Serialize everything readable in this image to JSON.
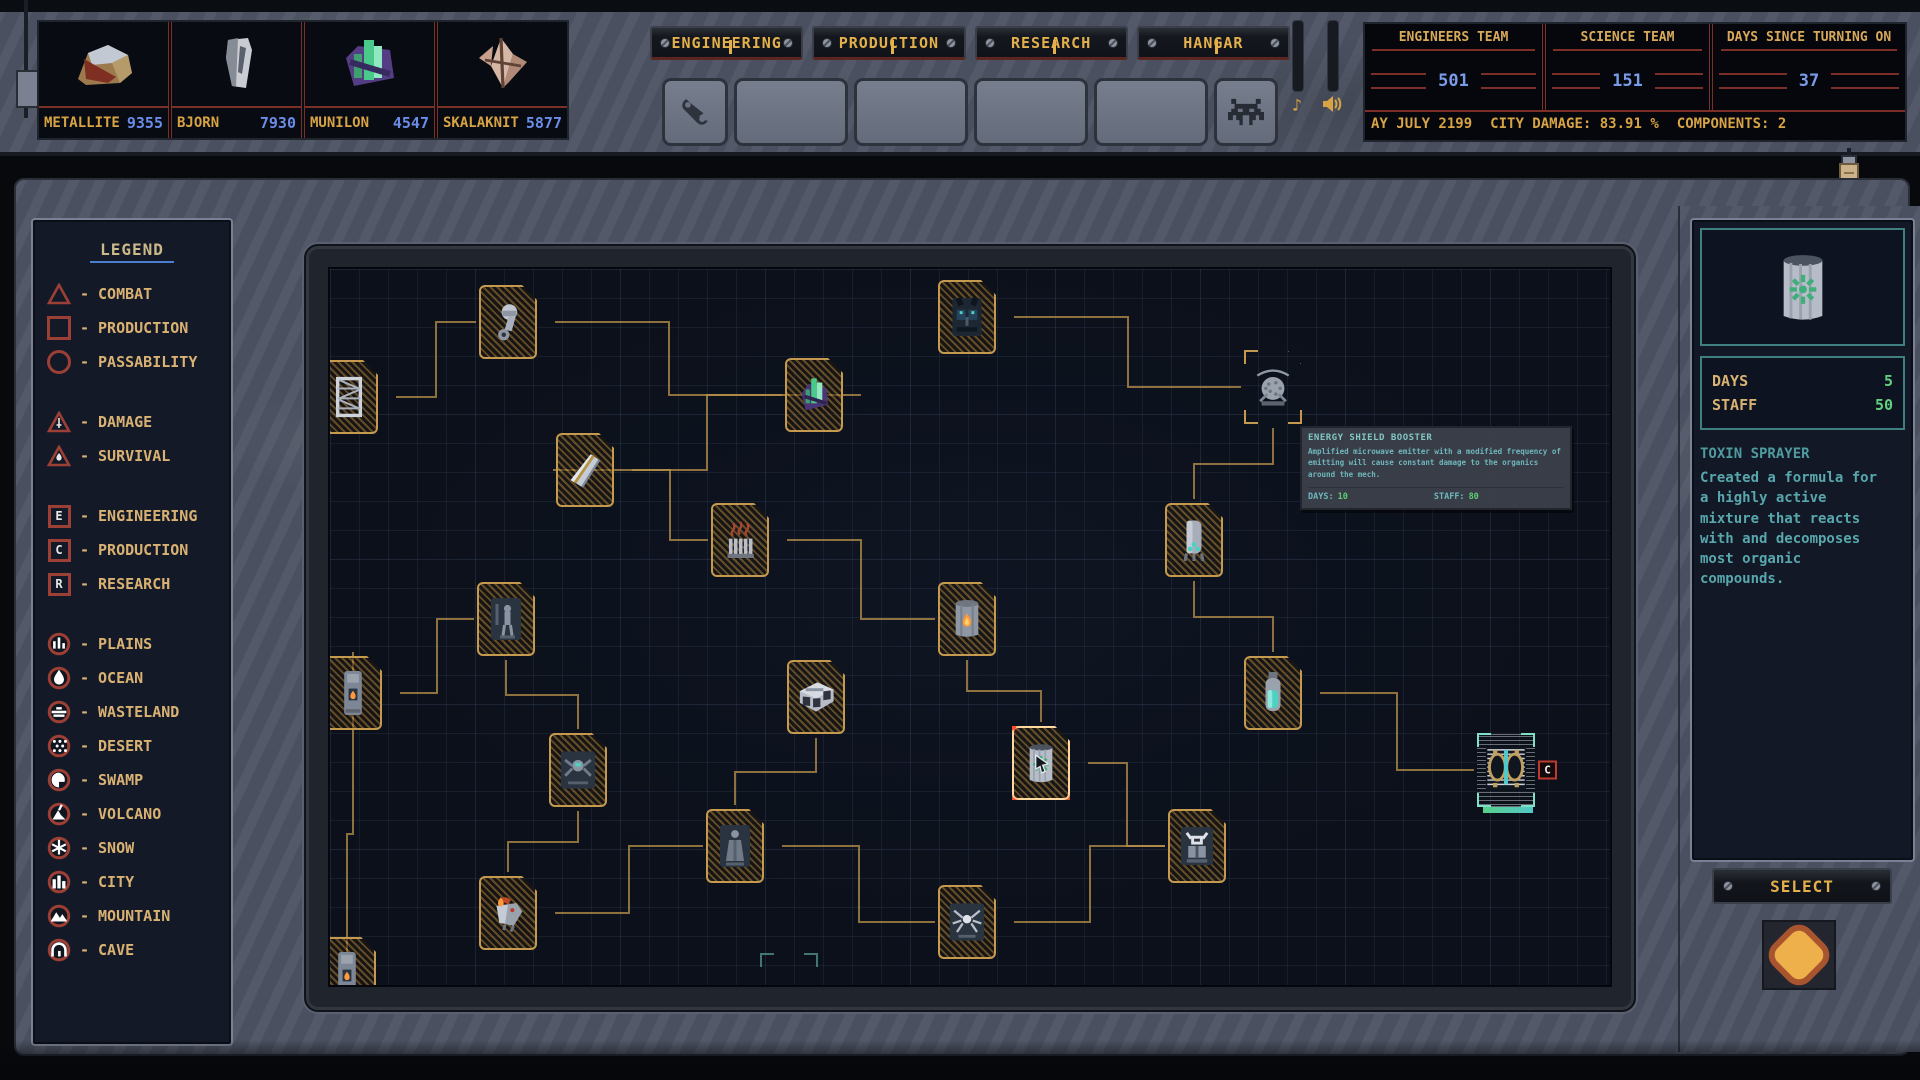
{
  "top_bar": {
    "resources": [
      {
        "name": "METALLITE",
        "value": "9355",
        "icon": "metallite-rock"
      },
      {
        "name": "BJORN",
        "value": "7930",
        "icon": "bjorn-ore"
      },
      {
        "name": "MUNILON",
        "value": "4547",
        "icon": "munilon-crystal"
      },
      {
        "name": "SKALAKNIT",
        "value": "5877",
        "icon": "skalaknit-shard"
      }
    ],
    "tabs": [
      {
        "label": "ENGINEERING"
      },
      {
        "label": "PRODUCTION"
      },
      {
        "label": "RESEARCH"
      },
      {
        "label": "HANGAR"
      }
    ],
    "tool_slots": [
      {
        "icon": "wrench",
        "width": 60
      },
      {
        "icon": "",
        "width": 108
      },
      {
        "icon": "",
        "width": 108
      },
      {
        "icon": "",
        "width": 108
      },
      {
        "icon": "",
        "width": 108
      },
      {
        "icon": "invader",
        "width": 58
      }
    ],
    "audio": {
      "music_icon": "music-note",
      "sound_icon": "speaker"
    },
    "stats": [
      {
        "title": "ENGINEERS TEAM",
        "value": "501",
        "width": 177
      },
      {
        "title": "SCIENCE TEAM",
        "value": "151",
        "width": 163
      },
      {
        "title": "DAYS SINCE TURNING ON",
        "value": "37",
        "width": 192
      }
    ],
    "ticker": {
      "date": "AY JULY 2199",
      "city_damage_label": "CITY DAMAGE:",
      "city_damage_value": "83.91 %",
      "components_label": "COMPONENTS:",
      "components_value": "2"
    }
  },
  "legend": {
    "title": "LEGEND",
    "shape_items": [
      {
        "icon": "triangle-outline",
        "label": "COMBAT"
      },
      {
        "icon": "square-outline",
        "label": "PRODUCTION"
      },
      {
        "icon": "circle-outline",
        "label": "PASSABILITY"
      }
    ],
    "hazard_items": [
      {
        "icon": "triangle-sword",
        "label": "DAMAGE"
      },
      {
        "icon": "triangle-flame",
        "label": "SURVIVAL"
      }
    ],
    "letter_items": [
      {
        "letter": "E",
        "label": "ENGINEERING"
      },
      {
        "letter": "C",
        "label": "PRODUCTION"
      },
      {
        "letter": "R",
        "label": "RESEARCH"
      }
    ],
    "terrain_items": [
      {
        "icon": "plains",
        "label": "PLAINS"
      },
      {
        "icon": "ocean",
        "label": "OCEAN"
      },
      {
        "icon": "wasteland",
        "label": "WASTELAND"
      },
      {
        "icon": "desert",
        "label": "DESERT"
      },
      {
        "icon": "swamp",
        "label": "SWAMP"
      },
      {
        "icon": "volcano",
        "label": "VOLCANO"
      },
      {
        "icon": "snow",
        "label": "SNOW"
      },
      {
        "icon": "city",
        "label": "CITY"
      },
      {
        "icon": "mountain",
        "label": "MOUNTAIN"
      },
      {
        "icon": "cave",
        "label": "CAVE"
      }
    ]
  },
  "map": {
    "nodes": [
      {
        "name": "node-piston",
        "icon": "piston",
        "x": 149,
        "y": 16,
        "state": "normal",
        "badge": {
          "type": "letter",
          "label": "C"
        }
      },
      {
        "name": "node-bat-armor",
        "icon": "bat-armor",
        "x": 608,
        "y": 11,
        "state": "normal",
        "badge": {
          "type": "letter",
          "label": "C"
        }
      },
      {
        "name": "node-lattice",
        "icon": "lattice",
        "x": -10,
        "y": 91,
        "state": "normal",
        "badge": {
          "type": "letter",
          "label": "R"
        }
      },
      {
        "name": "node-crystal",
        "icon": "crystal",
        "x": 455,
        "y": 89,
        "state": "normal",
        "badge": {
          "type": "letter",
          "label": "C"
        }
      },
      {
        "name": "node-shield-dome",
        "icon": "dome-emitter",
        "x": 914,
        "y": 81,
        "state": "hover",
        "badge": {
          "type": "damage"
        }
      },
      {
        "name": "node-metal-plate",
        "icon": "metal-plate",
        "x": 226,
        "y": 164,
        "state": "normal",
        "badge": {
          "type": "survival"
        }
      },
      {
        "name": "node-heater",
        "icon": "heater",
        "x": 381,
        "y": 234,
        "state": "normal",
        "badge": {
          "type": "circle-volcano"
        }
      },
      {
        "name": "node-missile",
        "icon": "missile",
        "x": 835,
        "y": 234,
        "state": "normal",
        "badge": {
          "type": "damage"
        }
      },
      {
        "name": "node-pilot",
        "icon": "pilot",
        "x": 147,
        "y": 313,
        "state": "normal",
        "badge": {
          "type": "letter",
          "label": "C"
        }
      },
      {
        "name": "node-furnace",
        "icon": "furnace-barrel",
        "x": 608,
        "y": 313,
        "state": "normal",
        "badge": {
          "type": "damage"
        }
      },
      {
        "name": "node-boiler",
        "icon": "boiler",
        "x": -6,
        "y": 387,
        "state": "normal",
        "badge": {
          "type": "survival"
        }
      },
      {
        "name": "node-fabricator",
        "icon": "fabricator",
        "x": 457,
        "y": 391,
        "state": "normal",
        "badge": {
          "type": "circle-ocean"
        }
      },
      {
        "name": "node-vial",
        "icon": "vial",
        "x": 914,
        "y": 387,
        "state": "normal",
        "badge": {
          "type": "letter",
          "label": "C"
        }
      },
      {
        "name": "node-spider-drone",
        "icon": "spider-drone",
        "x": 219,
        "y": 464,
        "state": "normal",
        "badge": {
          "type": "letter",
          "label": "C"
        }
      },
      {
        "name": "node-toxin-sprayer",
        "icon": "toxin-canister",
        "x": 682,
        "y": 457,
        "state": "selected",
        "badge": {
          "type": "damage"
        }
      },
      {
        "name": "node-portal-gate",
        "icon": "portal-gate",
        "x": 1147,
        "y": 464,
        "state": "special",
        "badge": {
          "type": "letter",
          "label": "C"
        }
      },
      {
        "name": "node-robed-figure",
        "icon": "robed-figure",
        "x": 376,
        "y": 540,
        "state": "normal",
        "badge": {
          "type": "letter",
          "label": "C"
        }
      },
      {
        "name": "node-samurai",
        "icon": "samurai-mech",
        "x": 838,
        "y": 540,
        "state": "normal",
        "badge": {
          "type": "letter",
          "label": "C"
        }
      },
      {
        "name": "node-phoenix",
        "icon": "phoenix-bird",
        "x": 149,
        "y": 607,
        "state": "normal",
        "badge": {
          "type": "survival"
        }
      },
      {
        "name": "node-spider-mech",
        "icon": "spider-mech",
        "x": 608,
        "y": 616,
        "state": "normal",
        "badge": {
          "type": "letter",
          "label": "C"
        }
      },
      {
        "name": "node-edge-left",
        "icon": "boiler",
        "x": -12,
        "y": 668,
        "state": "normal",
        "badge": {
          "type": "survival"
        }
      },
      {
        "name": "node-ghost",
        "icon": "none",
        "x": 430,
        "y": 684,
        "state": "ghost",
        "badge": null
      }
    ],
    "edges": [
      [
        2,
        0
      ],
      [
        0,
        3
      ],
      [
        1,
        4
      ],
      [
        3,
        5
      ],
      [
        5,
        6
      ],
      [
        6,
        9
      ],
      [
        4,
        7
      ],
      [
        7,
        12
      ],
      [
        9,
        14
      ],
      [
        8,
        13
      ],
      [
        10,
        8
      ],
      [
        11,
        16
      ],
      [
        12,
        15
      ],
      [
        13,
        18
      ],
      [
        18,
        16
      ],
      [
        16,
        19
      ],
      [
        19,
        17
      ],
      [
        14,
        17
      ],
      [
        20,
        10
      ]
    ]
  },
  "tooltip": {
    "title": "ENERGY SHIELD BOOSTER",
    "body": "Amplified microwave emitter with a modified frequency of emitting will cause constant damage to the organics around the mech.",
    "days_label": "DAYS:",
    "days_value": "10",
    "staff_label": "STAFF:",
    "staff_value": "80"
  },
  "detail_panel": {
    "preview_icon": "toxin-canister",
    "days_label": "DAYS",
    "days_value": "5",
    "staff_label": "STAFF",
    "staff_value": "50",
    "title": "TOXIN SPRAYER",
    "description": "Created a formula for a highly active mixture that reacts with and decomposes most organic compounds.",
    "select_label": "SELECT"
  },
  "colors": {
    "accent_yellow": "#e3b04b",
    "value_blue": "#6b8ce8",
    "legend_red": "#9c3f35",
    "teal_text": "#58a7ad",
    "green_value": "#62d080",
    "connector": "#b9924a"
  }
}
